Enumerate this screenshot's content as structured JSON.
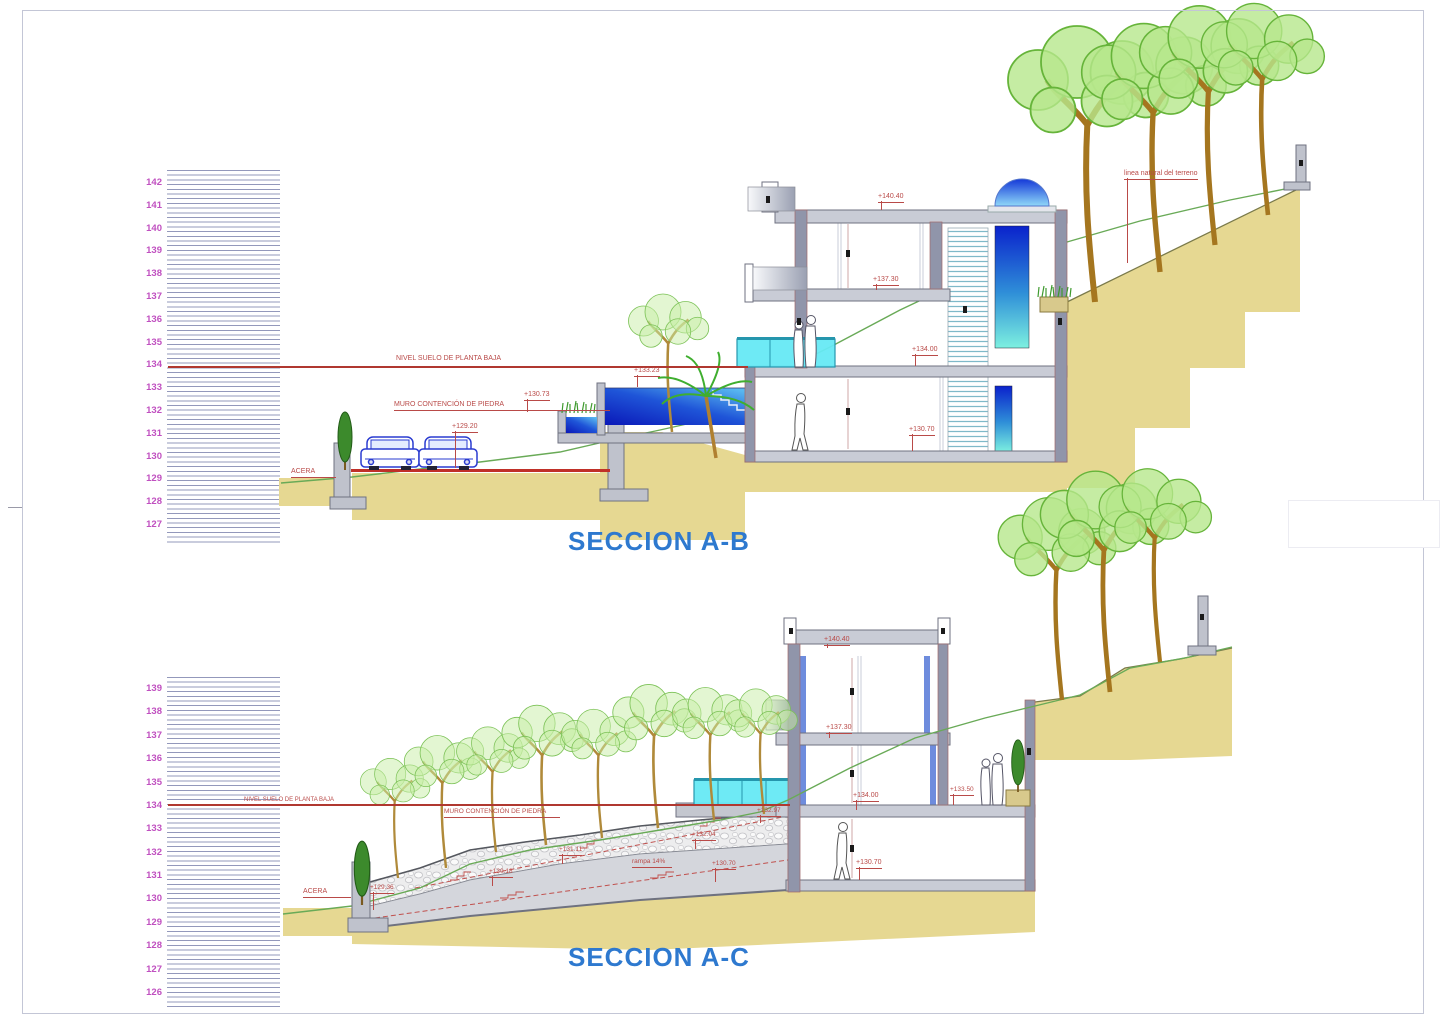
{
  "ab": {
    "title": "SECCION A-B",
    "scale": [
      "142",
      "141",
      "140",
      "139",
      "138",
      "137",
      "136",
      "135",
      "134",
      "133",
      "132",
      "131",
      "130",
      "129",
      "128",
      "127"
    ],
    "ground_line": "NIVEL SUELO DE PLANTA BAJA",
    "retaining_wall": "MURO CONTENCIÓN DE PIEDRA",
    "sidewalk": "ACERA",
    "terrain_line": "linea natural del terreno",
    "levels": {
      "street": "+129.20",
      "planter": "+130.73",
      "pool": "+133.23",
      "roof": "+140.40",
      "upper_floor": "+137.30",
      "ground_floor": "+134.00",
      "basement": "+130.70"
    }
  },
  "ac": {
    "title": "SECCION A-C",
    "scale": [
      "139",
      "138",
      "137",
      "136",
      "135",
      "134",
      "133",
      "132",
      "131",
      "130",
      "129",
      "128",
      "127",
      "126"
    ],
    "ground_line": "NIVEL SUELO DE PLANTA BAJA",
    "retaining_wall": "MURO CONTENCIÓN DE PIEDRA",
    "sidewalk": "ACERA",
    "ramp": "rampa 14%",
    "levels": {
      "street": "+129.36",
      "stair_1": "+130.18",
      "stair_2": "+131.11",
      "stair_3": "+132.04",
      "stair_4": "+132.97",
      "ramp_level": "+130.70",
      "roof": "+140.40",
      "upper_floor": "+137.30",
      "ground_floor": "+134.00",
      "terrace": "+133.50",
      "basement": "+130.70"
    }
  },
  "colors": {
    "scale_numbers": "#c050c0",
    "annotations": "#b94a48",
    "section_titles": "#2e79cf",
    "terrain": "#e6d892",
    "concrete": "#c9ccd6",
    "pool_water": "#0a18b8",
    "glass": "#66e9f4",
    "tree_green": "#b7e78c",
    "terrain_natural_line": "#69aa57"
  }
}
